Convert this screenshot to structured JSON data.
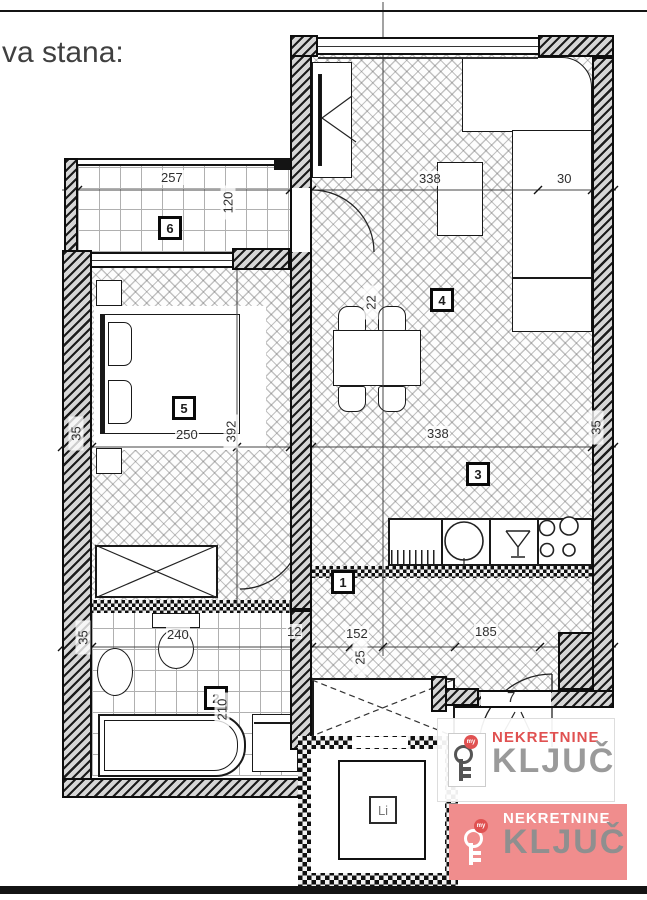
{
  "title": "va stana:",
  "rooms": {
    "hall": "1",
    "bath": "2",
    "kitchen": "3",
    "dining": "4",
    "bedroom": "5",
    "terrace": "6"
  },
  "labels": {
    "lift": "Li",
    "entry": "7"
  },
  "dims": {
    "terrace_w": "257",
    "terrace_d": "120",
    "living_w": "338",
    "sofa_d": "30",
    "wall_l": "35",
    "bed_w": "250",
    "bed_d": "392",
    "living_w2": "338",
    "wall_r": "35",
    "wall_bl": "35",
    "bath_w": "240",
    "bath_d": "210",
    "seg_12": "12",
    "seg_152": "152",
    "seg_25": "25",
    "entry_w": "185",
    "table_d": "22"
  },
  "watermark": {
    "name": "NEKRETNINE",
    "brand": "KLJUČ",
    "key_tag": "my"
  },
  "colors": {
    "wall": "#141414",
    "dim": "#2e2e2e",
    "logo_red": "#e05151",
    "logo_gray": "#9a9a9a",
    "logo2_bg": "#f08d8d"
  }
}
